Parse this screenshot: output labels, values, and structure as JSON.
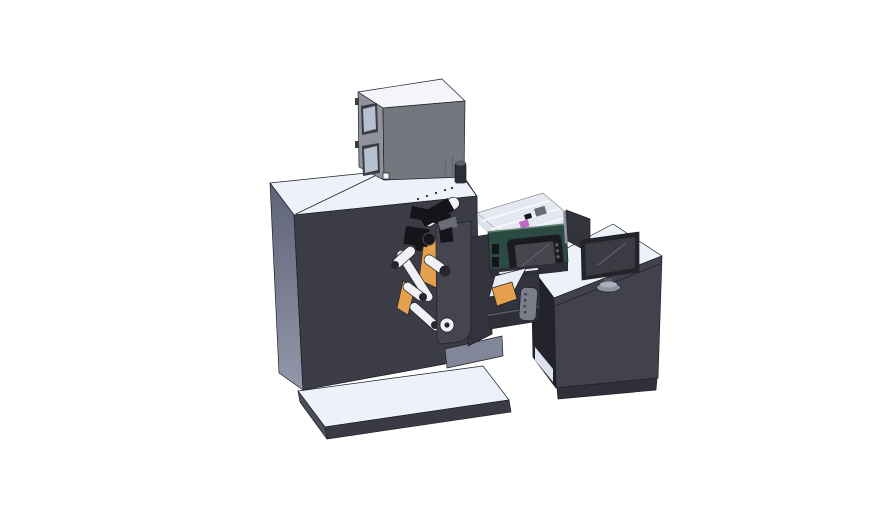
{
  "scene": {
    "type": "3d-cad-render",
    "description": "Isometric CAD rendering of a compact label printing and rewinding machine: dark press cabinet on a base plate, electrical control cabinet on top, web guide rollers with orange media rolls on a rewind plate, a green print engine with display under a transparent safety cover, and an adjacent operator desk with a monitor and a rear display panel",
    "background": "#ffffff"
  },
  "parts": {
    "machine": "main press cabinet",
    "control_cabinet": "electrical control cabinet",
    "base_platform": "floor base plate",
    "rewind_plate": "rewind turret plate",
    "rollers": "web guide rollers",
    "media_rolls": "orange media rolls",
    "print_unit": "green print engine with display",
    "cover": "transparent safety cover",
    "desk": "operator desk",
    "monitor": "desktop monitor",
    "rear_panel": "secondary display panel",
    "pendant": "hand-held controller"
  },
  "colors": {
    "background": "#ffffff",
    "outline": "#202028",
    "surface_top": "#edf1f9",
    "machine_front": "#3c3c46",
    "machine_left_top": "#5f6377",
    "machine_left_bottom": "#9297aa",
    "platform_front": "#3a3a44",
    "platform_left": "#4e4e59",
    "step_gray": "#828699",
    "lower_cabinet": "#33333d",
    "cabinet_top": "#f3f5fa",
    "cabinet_left": "#90939c",
    "cabinet_front": "#75777f",
    "cabinet_window": "#b7c0d0",
    "window_frame": "#3c3c44",
    "cabinet_detail": "#5c5e66",
    "cylinder_dark": "#2e2e36",
    "cylinder_cap": "#5b5d68",
    "roller_body": "#eff1f6",
    "roller_edge": "#9aa0af",
    "roller_cap": "#26262e",
    "media_orange": "#e5a04e",
    "plate_gray": "#45454f",
    "mech_black": "#14141a",
    "mech_gray": "#6a6d78",
    "printer_green": "#2b4b42",
    "printer_green_edge": "#5d8272",
    "display_bezel": "#1a1a20",
    "display_screen": "#45454e",
    "screen_sheen": "#5e5e68",
    "enclosure_glass": "#ccd3e2",
    "enclosure_rail": "#f5f7fc",
    "magenta_part": "#c06ac4",
    "deck_dark": "#2e2e37",
    "slot_white": "#e8ebf2",
    "tray_white": "#e9edf5",
    "desk_front": "#42424c",
    "desk_kick": "#30303a",
    "desk_interior": "#23232b",
    "desk_floor": "#dde2ee",
    "rear_panel": "#33333c",
    "monitor_bezel": "#24242b",
    "monitor_screen": "#3b3b43",
    "monitor_stand": "#8e92a2",
    "stand_top": "#aab0bf",
    "neck_gray": "#5a5d68",
    "pendant_gray": "#7a7d8a",
    "arm_dark": "#2f2f38",
    "dot_dark": "#2d2d36"
  }
}
